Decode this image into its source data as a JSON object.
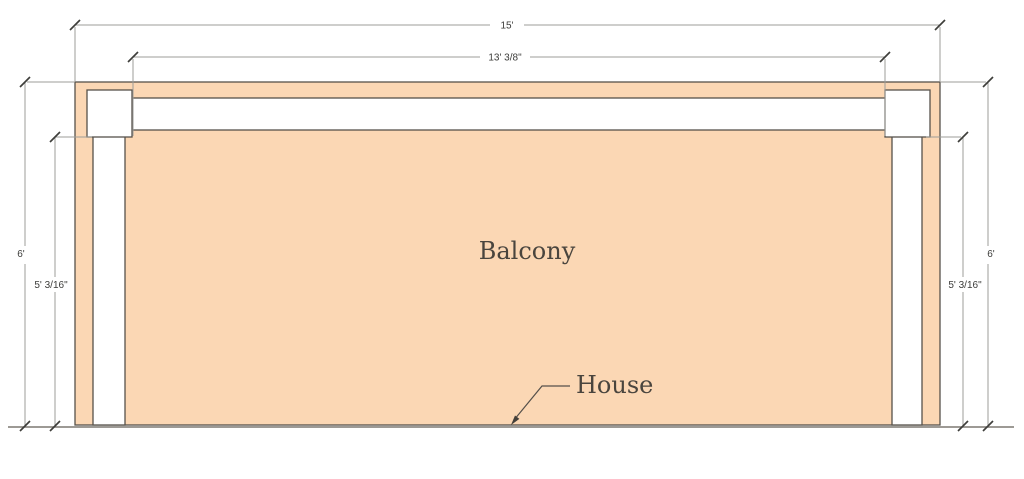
{
  "drawing": {
    "balcony_label": "Balcony",
    "house_label": "House",
    "dimensions": {
      "top_outer_width": "15'",
      "top_inner_width": "13' 3/8\"",
      "left_outer_depth": "6'",
      "left_inner_depth": "5' 3/16\"",
      "right_outer_depth": "6'",
      "right_inner_depth": "5' 3/16\""
    },
    "colors": {
      "deck_fill": "#fbd7b4"
    }
  }
}
